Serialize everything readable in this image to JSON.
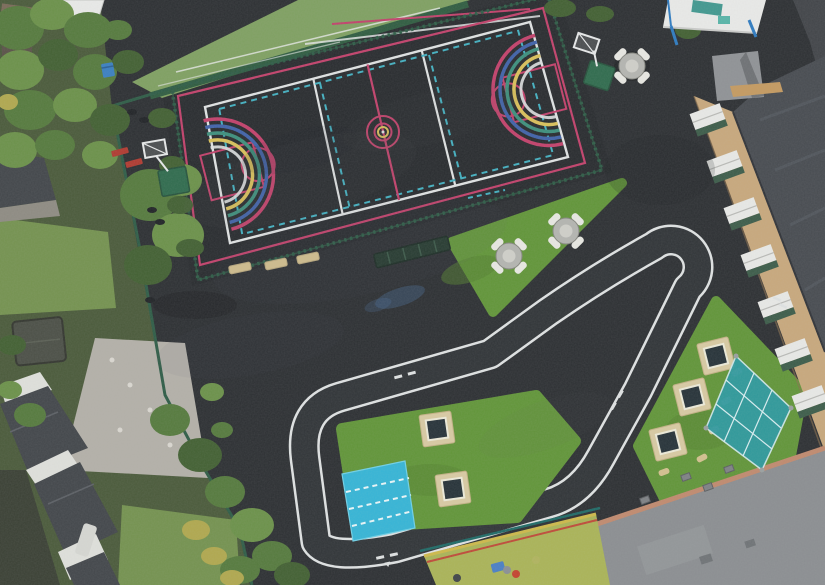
{
  "scene": {
    "title": "Aerial drone view of a school playground",
    "regions": [
      "multi-use games court",
      "white roadway cycle track with hairpin",
      "artificial turf islands",
      "school brick building",
      "residential gardens and houses",
      "artificial grass pitch",
      "early-years play area"
    ]
  },
  "colors": {
    "tarmac": "#2c2f32",
    "court_backing": "#26282b",
    "track_surface": "#303437",
    "line_white": "#dfe2e2",
    "line_pink": "#c2416b",
    "line_cyan": "#43b0c0",
    "arc_yellow": "#d9c05a",
    "arc_teal": "#3d8f7c",
    "arc_blue": "#4062a8",
    "field_green": "#7fa061",
    "field_hedge": "#2f5c40",
    "fence_green": "#2e5c46",
    "turf_green": "#619538",
    "mat_cyan": "#35b5d6",
    "mat_dash": "#e8f6f8",
    "canopy_white": "#e9eae8",
    "canopy_frame_blue": "#2e7bc0",
    "canopy_teal": "#2d9aa0",
    "tramp_frame": "#d8caa2",
    "tramp_bed": "#263238",
    "table_top": "#b4b5b0",
    "table_seat": "#e8e8e2",
    "beam_tan": "#d3c08e",
    "bench_red": "#b03a30",
    "bin_blue": "#3a7fc0",
    "hoop_green": "#2f6b4d",
    "brick": "#c8a87c",
    "window_white": "#e8e9e6",
    "window_panel": "#3c5c49",
    "roof_dark": "#474b50",
    "roof_light": "#8b8e91",
    "brick_edge": "#c08a6e",
    "house_wall": "#dfe0db",
    "house_roof": "#42464a",
    "paving": "#b3b0a8",
    "lawn": "#74924f",
    "garden_base": "#4a5a3a",
    "shed": "#4b4f46",
    "path_light": "#565a5e",
    "play_area": "#aab457",
    "play_border_yellow": "#cdb94a",
    "play_border_red": "#bf4a38",
    "play_fence": "#1f6a66",
    "tree_shades": [
      "#426032",
      "#557a3d",
      "#6b9149",
      "#87a55a",
      "#b0a84e"
    ]
  },
  "equipment": {
    "picnic_tables": [
      [
        509,
        256
      ],
      [
        566,
        231
      ],
      [
        632,
        66
      ]
    ],
    "trampolines": [
      [
        437,
        429,
        -8
      ],
      [
        453,
        489,
        -8
      ],
      [
        716,
        356,
        -14
      ],
      [
        692,
        397,
        -14
      ],
      [
        668,
        442,
        -14
      ]
    ],
    "balance_beams": [
      [
        240,
        268,
        -12
      ],
      [
        276,
        264,
        -12
      ],
      [
        308,
        258,
        -12
      ]
    ],
    "steppers": [
      [
        737,
        372,
        -30
      ],
      [
        726,
        401,
        -30
      ],
      [
        714,
        430,
        -28
      ],
      [
        702,
        458,
        -28
      ],
      [
        664,
        472,
        -20
      ]
    ],
    "red_benches": [
      [
        120,
        152,
        -15
      ],
      [
        134,
        163,
        -15
      ]
    ],
    "loose_items": [
      [
        132,
        112
      ],
      [
        144,
        120
      ],
      [
        152,
        210
      ],
      [
        160,
        222
      ],
      [
        150,
        300
      ]
    ],
    "basketball_hoops": 2,
    "canopies": 2
  },
  "school_building": {
    "windows": [
      [
        708,
        118
      ],
      [
        725,
        165
      ],
      [
        742,
        212
      ],
      [
        759,
        259
      ],
      [
        776,
        306
      ],
      [
        793,
        353
      ],
      [
        810,
        400
      ]
    ],
    "window_tilt": -20
  },
  "site_details": {
    "drains": [
      [
        686,
        477
      ],
      [
        708,
        487
      ],
      [
        729,
        469
      ],
      [
        645,
        500
      ]
    ],
    "white_marks": [
      [
        777,
        299
      ],
      [
        783,
        306
      ]
    ],
    "play_items": [
      [
        498,
        567,
        "#4a7fc4",
        "r"
      ],
      [
        516,
        574,
        "#c4432e",
        "c"
      ],
      [
        507,
        570,
        "#8a8f94",
        "c"
      ],
      [
        457,
        578,
        "#3f4448",
        "c"
      ],
      [
        536,
        560,
        "#b0b45e",
        "c"
      ]
    ],
    "paving_stones": [
      [
        112,
        360
      ],
      [
        130,
        385
      ],
      [
        150,
        410
      ],
      [
        120,
        430
      ],
      [
        170,
        445
      ]
    ]
  },
  "vegetation": {
    "blobs": [
      [
        18,
        28,
        26,
        22,
        1
      ],
      [
        52,
        14,
        22,
        16,
        2
      ],
      [
        88,
        30,
        24,
        18,
        1
      ],
      [
        20,
        70,
        24,
        20,
        2
      ],
      [
        58,
        55,
        20,
        16,
        0
      ],
      [
        95,
        72,
        22,
        18,
        1
      ],
      [
        30,
        110,
        26,
        20,
        1
      ],
      [
        75,
        105,
        22,
        17,
        2
      ],
      [
        110,
        120,
        20,
        16,
        0
      ],
      [
        15,
        150,
        22,
        18,
        2
      ],
      [
        55,
        145,
        20,
        15,
        1
      ],
      [
        100,
        155,
        18,
        14,
        2
      ],
      [
        128,
        62,
        16,
        12,
        0
      ],
      [
        118,
        30,
        14,
        10,
        1
      ],
      [
        8,
        102,
        10,
        8,
        4
      ],
      [
        150,
        195,
        30,
        26,
        1
      ],
      [
        178,
        235,
        26,
        22,
        2
      ],
      [
        148,
        265,
        24,
        20,
        0
      ],
      [
        182,
        180,
        20,
        16,
        2
      ],
      [
        12,
        345,
        14,
        10,
        0
      ],
      [
        30,
        415,
        16,
        12,
        1
      ],
      [
        10,
        390,
        12,
        9,
        2
      ],
      [
        212,
        392,
        12,
        9,
        2
      ],
      [
        222,
        430,
        11,
        8,
        1
      ],
      [
        170,
        420,
        20,
        16,
        1
      ],
      [
        200,
        455,
        22,
        17,
        0
      ],
      [
        225,
        492,
        20,
        16,
        1
      ],
      [
        252,
        525,
        22,
        17,
        2
      ],
      [
        272,
        556,
        20,
        15,
        1
      ],
      [
        292,
        575,
        18,
        13,
        0
      ],
      [
        240,
        570,
        20,
        14,
        1
      ],
      [
        196,
        530,
        14,
        10,
        4
      ],
      [
        214,
        556,
        13,
        9,
        4
      ],
      [
        232,
        578,
        12,
        8,
        4
      ],
      [
        162,
        118,
        14,
        10,
        0
      ],
      [
        172,
        165,
        13,
        9,
        0
      ],
      [
        180,
        205,
        13,
        9,
        0
      ],
      [
        190,
        248,
        14,
        9,
        0
      ],
      [
        560,
        8,
        16,
        9,
        0
      ],
      [
        600,
        14,
        14,
        8,
        0
      ],
      [
        688,
        30,
        13,
        9,
        0
      ],
      [
        700,
        12,
        12,
        8,
        1
      ]
    ]
  }
}
